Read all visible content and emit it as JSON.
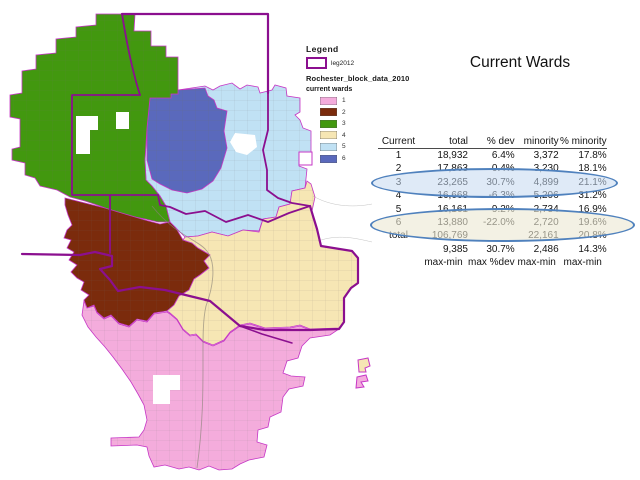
{
  "slide": {
    "title": "Current Wards",
    "background": "#FFFFFF"
  },
  "legend": {
    "title": "Legend",
    "boundary_item": {
      "label": "leg2012",
      "color": "#8B0F8F"
    },
    "dataset_label": "Rochester_block_data_2010",
    "layer_label": "current wards",
    "wards": [
      {
        "label": "1",
        "color": "#F4ACDC"
      },
      {
        "label": "2",
        "color": "#7B2B0C"
      },
      {
        "label": "3",
        "color": "#42980F"
      },
      {
        "label": "4",
        "color": "#F6E6B4"
      },
      {
        "label": "5",
        "color": "#C0E1F4"
      },
      {
        "label": "6",
        "color": "#5A69BC"
      }
    ]
  },
  "table": {
    "columns": [
      "Current",
      "total",
      "% dev",
      "minority",
      "% minority"
    ],
    "rows": [
      [
        "1",
        "18,932",
        "6.4%",
        "3,372",
        "17.8%"
      ],
      [
        "2",
        "17,863",
        "0.4%",
        "3,230",
        "18.1%"
      ],
      [
        "3",
        "23,265",
        "30.7%",
        "4,899",
        "21.1%"
      ],
      [
        "4",
        "16,668",
        "-6.3%",
        "5,206",
        "31.2%"
      ],
      [
        "5",
        "16,161",
        "-9.2%",
        "2,734",
        "16.9%"
      ],
      [
        "6",
        "13,880",
        "-22.0%",
        "2,720",
        "19.6%"
      ]
    ],
    "footer_rows": [
      [
        "total",
        "106,769",
        "",
        "22,161",
        "20.8%"
      ],
      [
        "",
        "9,385",
        "30.7%",
        "2,486",
        "14.3%"
      ],
      [
        "",
        "max-min",
        "max %dev",
        "max-min",
        "max-min"
      ]
    ]
  },
  "annotations": {
    "ellipse_wards_2_3": {
      "stroke": "#4F81BD",
      "fill": "#C5D9F1"
    },
    "ellipse_ward_6": {
      "stroke": "#4F81BD",
      "fill": "#EBE8D2"
    }
  },
  "map": {
    "name": "Rochester current wards map",
    "district_boundary_color": "#8B0F8F",
    "city_limit_color": "#C636C6"
  }
}
